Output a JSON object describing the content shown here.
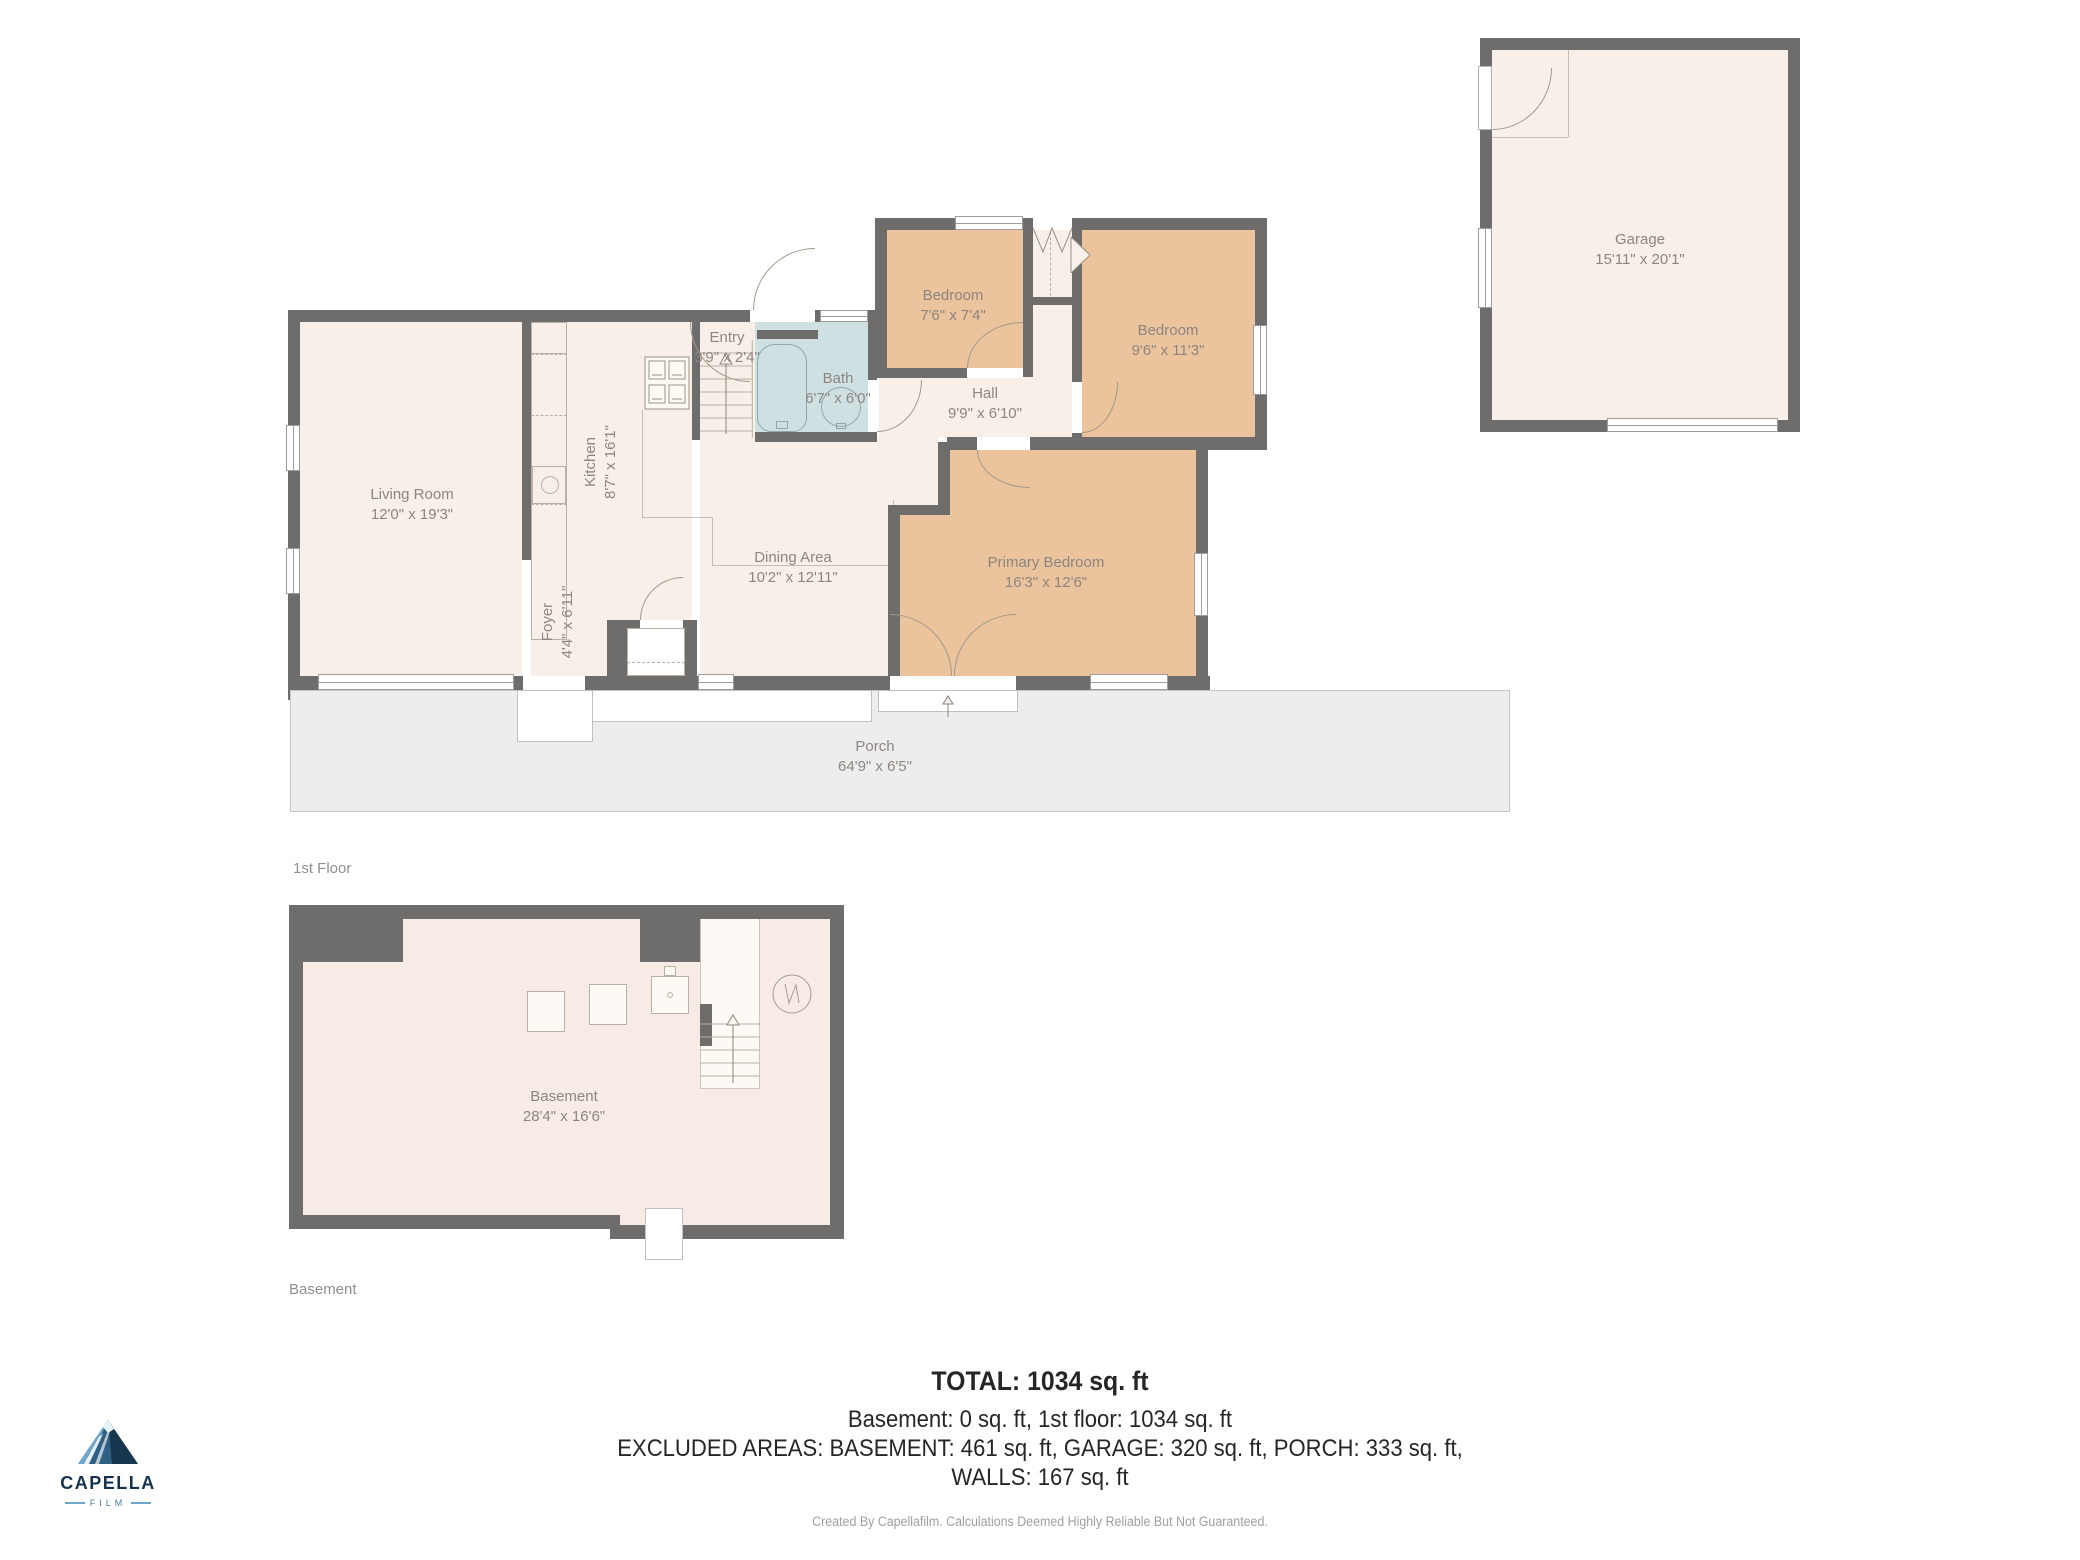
{
  "rooms": {
    "living": {
      "name": "Living Room",
      "dims": "12'0\" x 19'3\""
    },
    "kitchen": {
      "name": "Kitchen",
      "dims": "8'7\" x 16'1\""
    },
    "entry": {
      "name": "Entry",
      "dims": "3'9\" x 2'4\""
    },
    "bath": {
      "name": "Bath",
      "dims": "6'7\" x 6'0\""
    },
    "bedroom_small": {
      "name": "Bedroom",
      "dims": "7'6\" x 7'4\""
    },
    "bedroom_mid": {
      "name": "Bedroom",
      "dims": "9'6\" x 11'3\""
    },
    "hall": {
      "name": "Hall",
      "dims": "9'9\" x 6'10\""
    },
    "dining": {
      "name": "Dining Area",
      "dims": "10'2\" x 12'11\""
    },
    "foyer": {
      "name": "Foyer",
      "dims": "4'4\" x 6'11\""
    },
    "primary": {
      "name": "Primary Bedroom",
      "dims": "16'3\" x 12'6\""
    },
    "porch": {
      "name": "Porch",
      "dims": "64'9\" x 6'5\""
    },
    "garage": {
      "name": "Garage",
      "dims": "15'11\" x 20'1\""
    },
    "basement": {
      "name": "Basement",
      "dims": "28'4\" x 16'6\""
    }
  },
  "captions": {
    "first_floor": "1st Floor",
    "basement": "Basement"
  },
  "summary": {
    "total": "TOTAL: 1034 sq. ft",
    "line2": "Basement: 0 sq. ft, 1st floor: 1034 sq. ft",
    "line3": "EXCLUDED AREAS: BASEMENT: 461 sq. ft, GARAGE: 320 sq. ft, PORCH: 333 sq. ft,",
    "line4": "WALLS: 167 sq. ft",
    "disclaimer": "Created By Capellafilm. Calculations Deemed Highly Reliable But Not Guaranteed."
  },
  "logo": {
    "brand": "CAPELLA",
    "subtitle": "FILM"
  },
  "colors": {
    "wall": "#6f6c6c",
    "floor_cream": "#f7efe8",
    "bedroom_tan": "#ebc39d",
    "bath_blue": "#cfe0e2",
    "porch_gray": "#ededed",
    "label_text": "#8d8680",
    "summary_text": "#262626",
    "logo_navy": "#16324f",
    "logo_blue": "#6ca6c8"
  }
}
